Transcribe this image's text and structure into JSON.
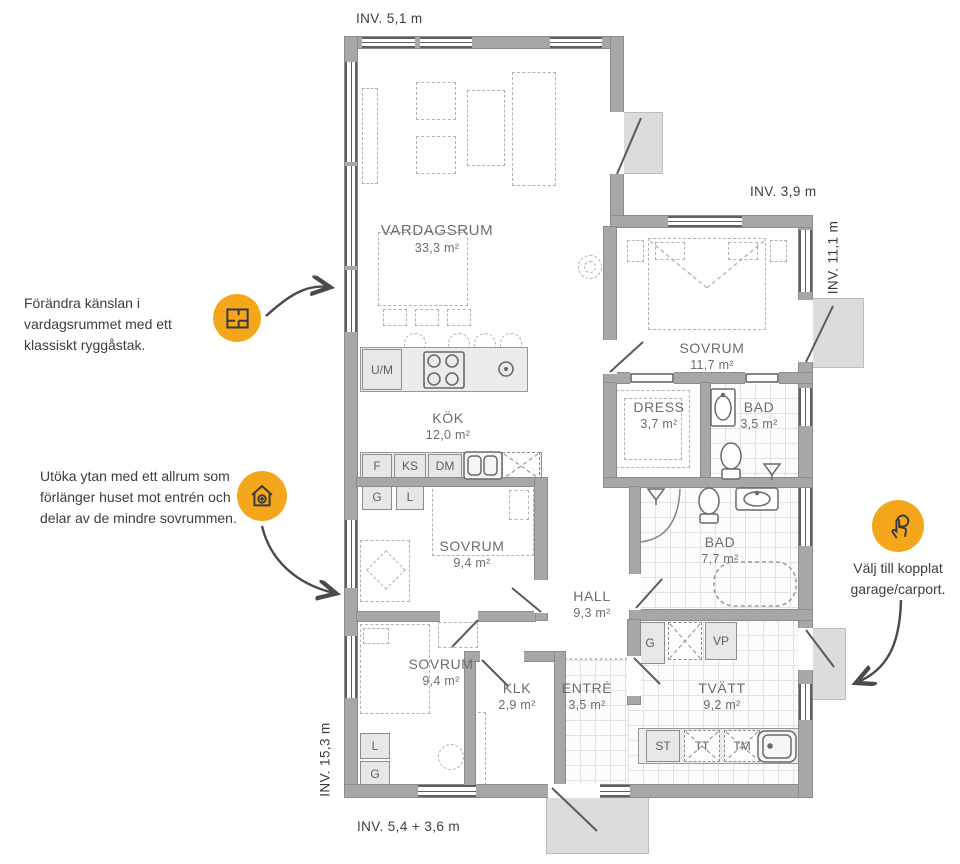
{
  "dimensions": {
    "top": "INV. 5,1 m",
    "top_right": "INV. 3,9 m",
    "right": "INV. 11,1 m",
    "left": "INV. 15,3 m",
    "bottom": "INV. 5,4 + 3,6 m"
  },
  "rooms": {
    "vardagsrum": {
      "name": "VARDAGSRUM",
      "area": "33,3 m²"
    },
    "kok": {
      "name": "KÖK",
      "area": "12,0 m²"
    },
    "sovrum1": {
      "name": "SOVRUM",
      "area": "11,7 m²"
    },
    "dress": {
      "name": "DRESS",
      "area": "3,7 m²"
    },
    "bad1": {
      "name": "BAD",
      "area": "3,5 m²"
    },
    "bad2": {
      "name": "BAD",
      "area": "7,7 m²"
    },
    "sovrum2": {
      "name": "SOVRUM",
      "area": "9,4 m²"
    },
    "sovrum3": {
      "name": "SOVRUM",
      "area": "9,4 m²"
    },
    "hall": {
      "name": "HALL",
      "area": "9,3 m²"
    },
    "klk": {
      "name": "KLK",
      "area": "2,9 m²"
    },
    "entre": {
      "name": "ENTRÉ",
      "area": "3,5 m²"
    },
    "tvatt": {
      "name": "TVÄTT",
      "area": "9,2 m²"
    }
  },
  "appliances": {
    "um": "U/M",
    "f": "F",
    "ks": "KS",
    "dm": "DM",
    "kok_g": "G",
    "kok_l": "L",
    "sov_l": "L",
    "sov_g": "G",
    "hall_g": "G",
    "vp": "VP",
    "st": "ST",
    "tt": "TT",
    "tm": "TM"
  },
  "annotations": {
    "ridge": {
      "text": "Förändra känslan i vardagsrummet med ett klassiskt ryggåstak.",
      "icon": "floorplan-icon"
    },
    "allrum": {
      "text": "Utöka ytan med ett allrum som förlänger huset mot entrén och delar av de mindre sovrummen.",
      "icon": "house-plus-icon"
    },
    "garage": {
      "text": "Välj till kopplat garage/carport.",
      "icon": "tap-select-icon"
    }
  },
  "colors": {
    "accent": "#F5A71B",
    "wall": "#A7A7A7",
    "line": "#5F5F5F"
  }
}
